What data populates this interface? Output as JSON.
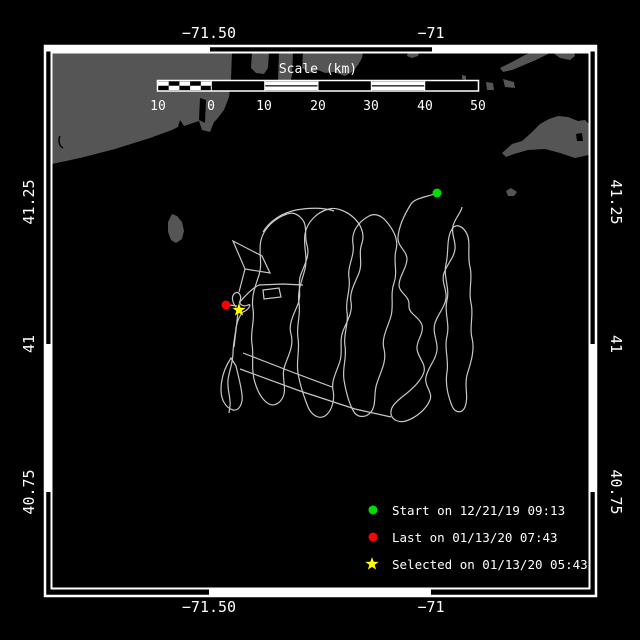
{
  "colors": {
    "background": "#000000",
    "land": "#555555",
    "water": "#000000",
    "frame": "#ffffff",
    "text": "#ffffff",
    "track": "#c8c8c8",
    "start_marker": "#00dd00",
    "last_marker": "#ff0000",
    "selected_marker": "#ffff00"
  },
  "axes": {
    "top": [
      {
        "label": "−71.50"
      },
      {
        "label": "−71"
      }
    ],
    "bottom": [
      {
        "label": "−71.50"
      },
      {
        "label": "−71"
      }
    ],
    "left": [
      {
        "label": "41.25"
      },
      {
        "label": "41"
      },
      {
        "label": "40.75"
      }
    ],
    "right": [
      {
        "label": "41.25"
      },
      {
        "label": "41"
      },
      {
        "label": "40.75"
      }
    ]
  },
  "scalebar": {
    "title": "Scale (km)",
    "ticks": [
      "10",
      "0",
      "10",
      "20",
      "30",
      "40",
      "50"
    ]
  },
  "legend": [
    {
      "marker": "circle",
      "color": "#00dd00",
      "label": "Start on 12/21/19 09:13"
    },
    {
      "marker": "circle",
      "color": "#ff0000",
      "label": "Last on 01/13/20 07:43"
    },
    {
      "marker": "star",
      "color": "#ffff00",
      "label": "Selected on 01/13/20 05:43"
    }
  ]
}
